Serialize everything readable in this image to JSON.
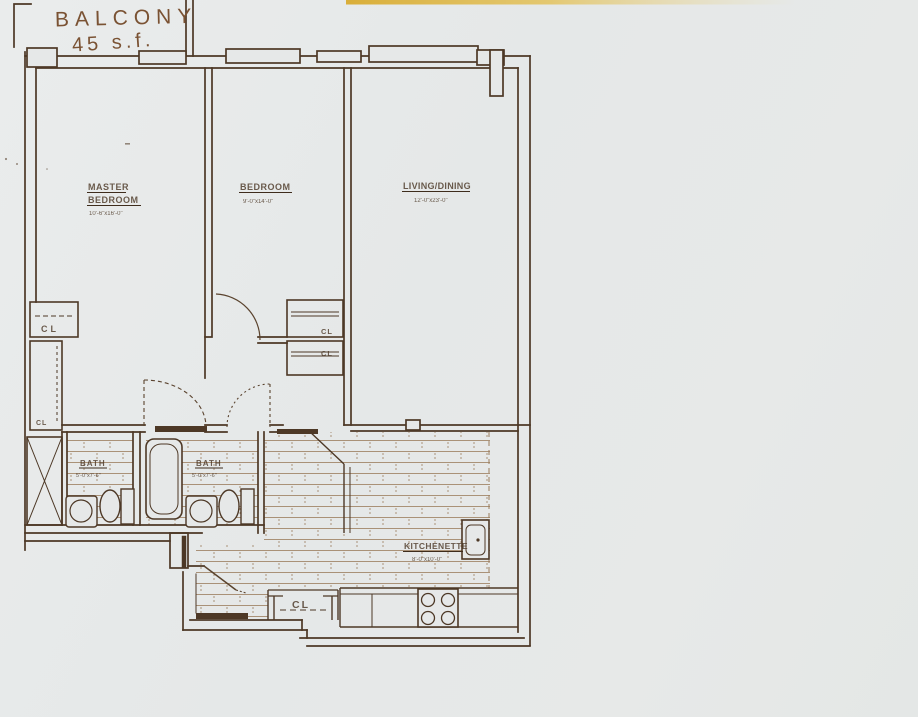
{
  "drawing": {
    "type": "apartment floor plan scan",
    "balcony_note": {
      "line1": "BALCONY",
      "line2": "45 s.f."
    },
    "rooms": {
      "master_bedroom": {
        "name_line1": "MASTER",
        "name_line2": "BEDROOM",
        "dims": "10'-6\"x16'-0\""
      },
      "bedroom": {
        "name": "BEDROOM",
        "dims": "9'-0\"x14'-0\""
      },
      "living_dining": {
        "name": "LIVING/DINING",
        "dims": "12'-0\"x23'-0\""
      },
      "kitchenette": {
        "name": "KITCHENETTE",
        "dims": "8'-0\"x10'-0\""
      },
      "bath_1": {
        "name": "BATH",
        "dims": "5'-0\"x7'-6\""
      },
      "bath_2": {
        "name": "BATH",
        "dims": "5'-0\"x7'-6\""
      }
    },
    "closet_labels": {
      "master_closet": "CL",
      "master_wardrobe": "CL",
      "bedroom_closet_upper": "CL",
      "hall_closet_lower": "CL",
      "entry_closet": "CL"
    },
    "colors": {
      "paper": "#e6e8e8",
      "ink": "#4d3826",
      "tile": "#9b7c5c",
      "handwriting": "#7a5233",
      "yellow_strip": "#dcb33f"
    }
  }
}
